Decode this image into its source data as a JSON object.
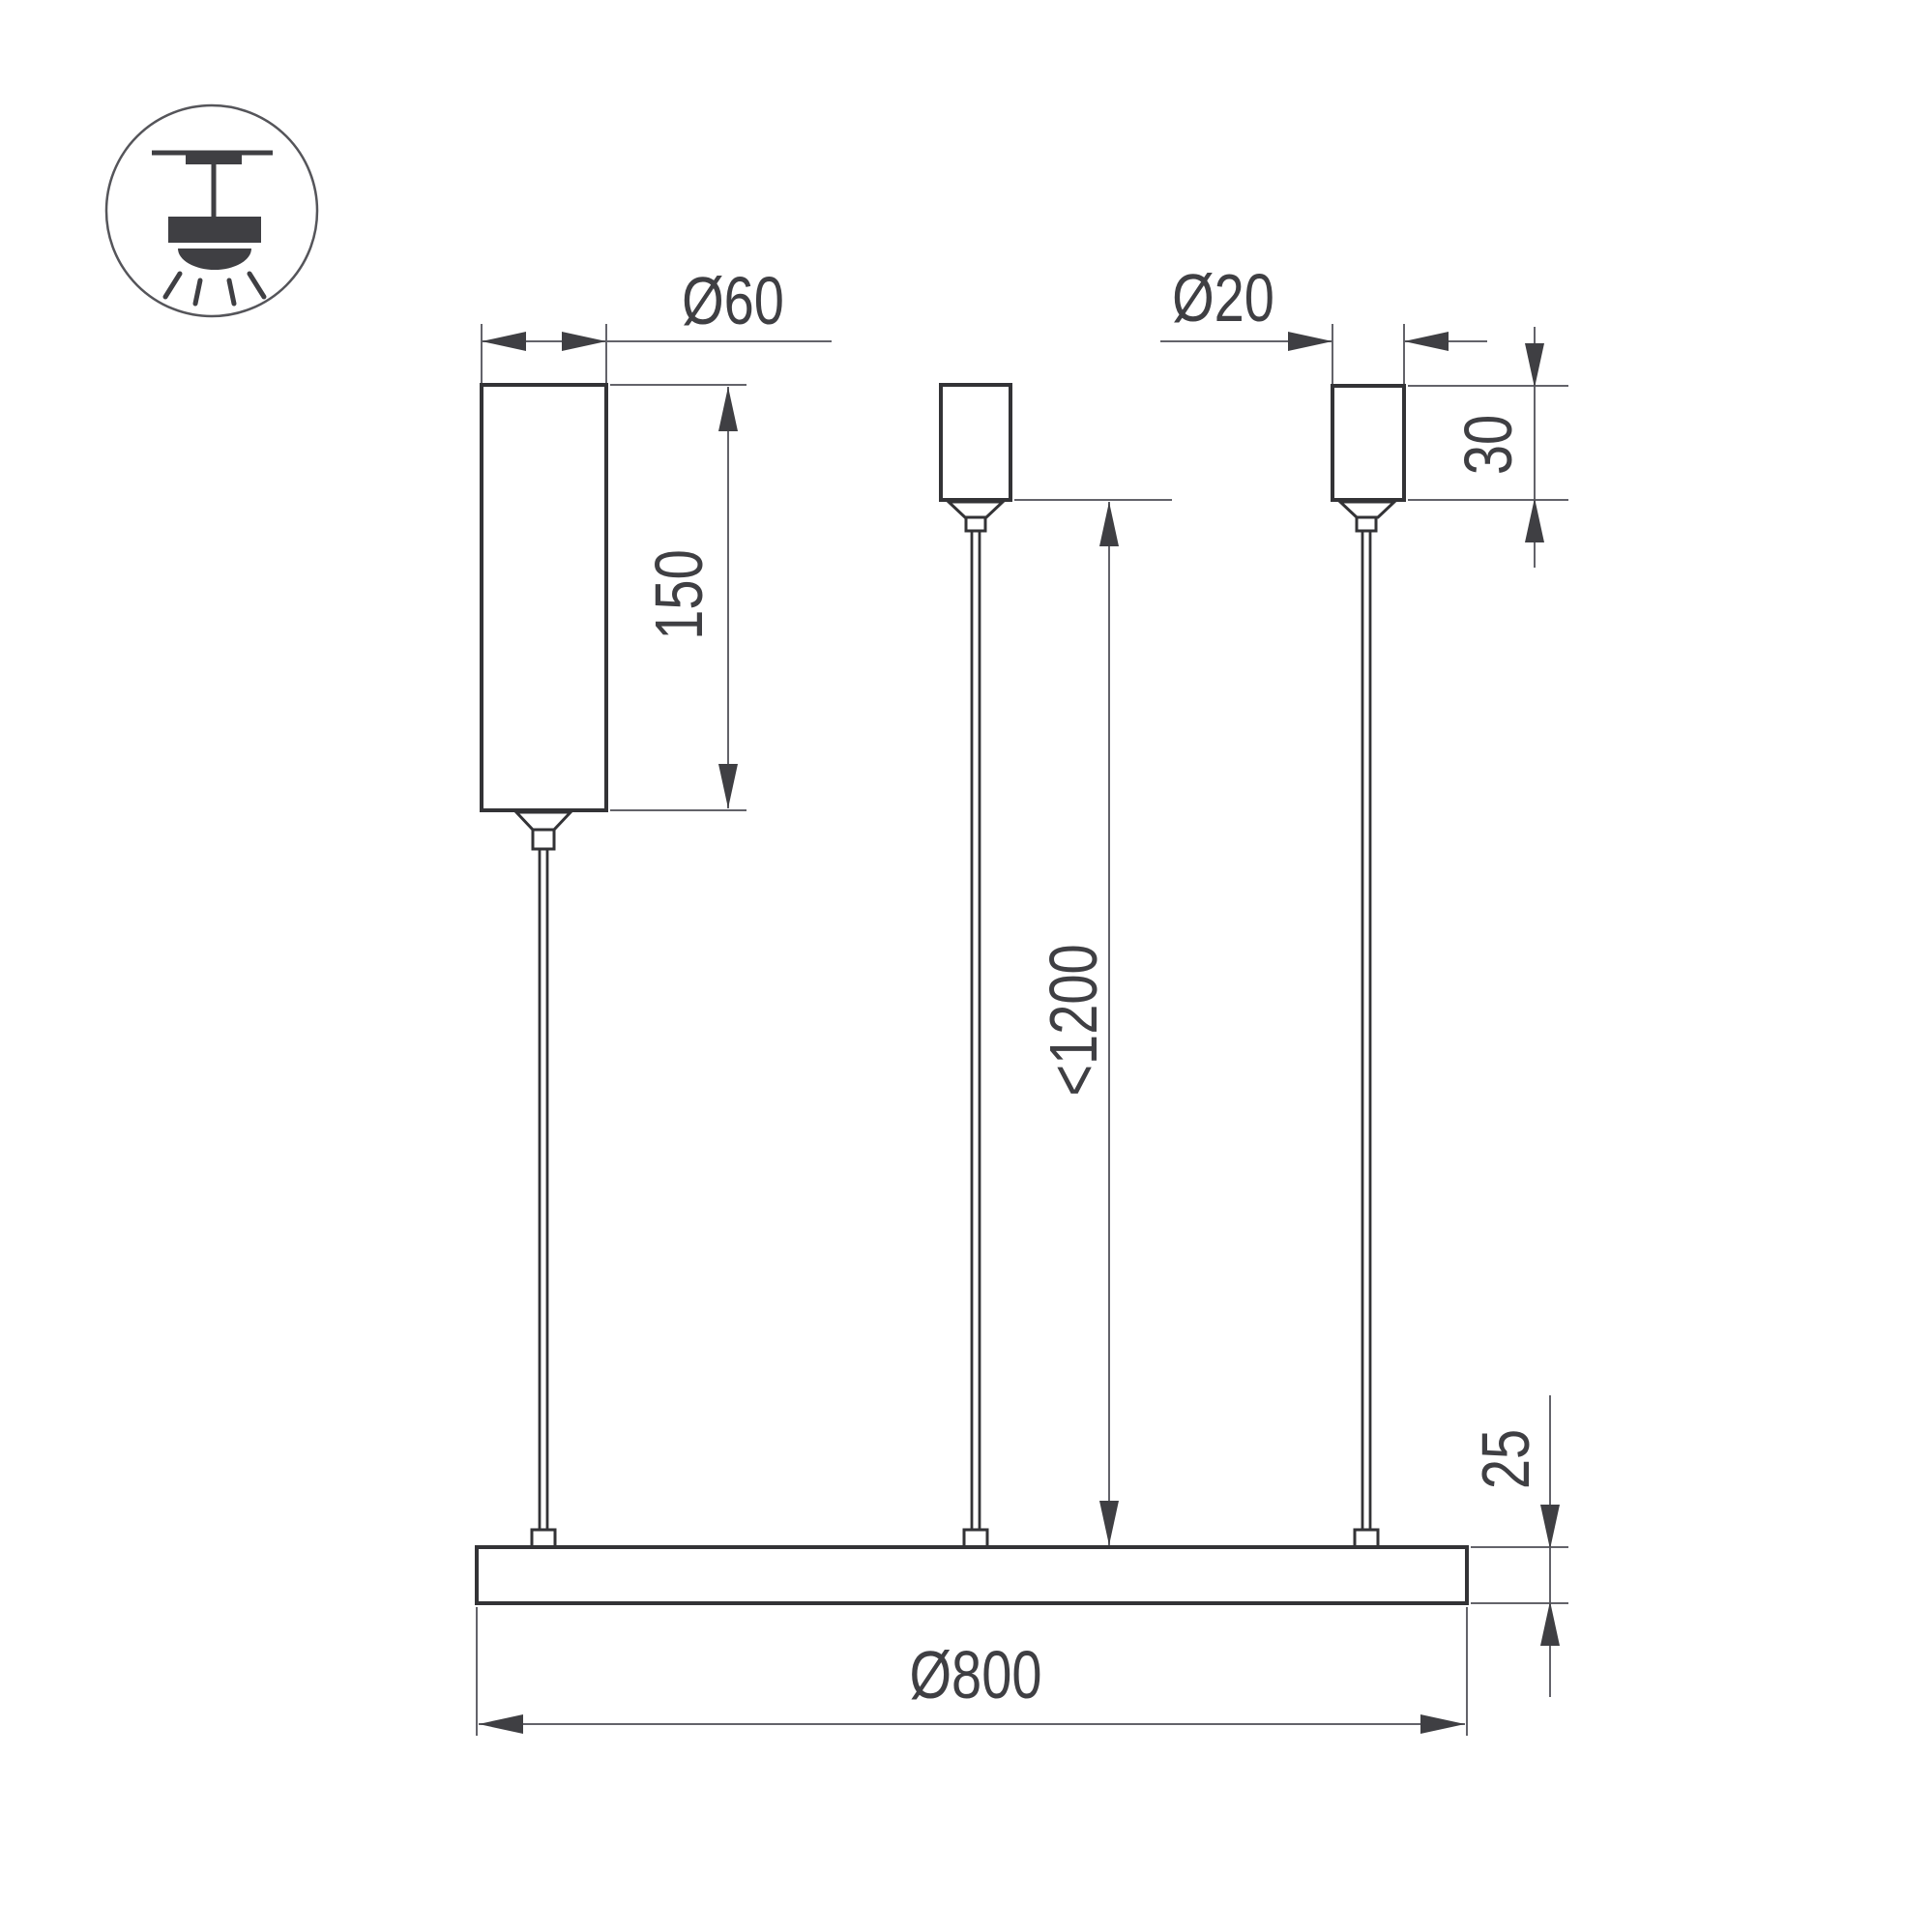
{
  "drawing": {
    "background_color": "#ffffff",
    "outline_color": "#333336",
    "dimension_line_color": "#63636a",
    "text_color": "#3f3f43",
    "icon": {
      "name": "pendant-ceiling-light-icon"
    },
    "labels": {
      "driver_diameter": "Ø60",
      "driver_height": "150",
      "canopy_diameter": "Ø20",
      "canopy_height": "30",
      "suspension_length": "<1200",
      "bar_height": "25",
      "bar_diameter": "Ø800"
    }
  }
}
